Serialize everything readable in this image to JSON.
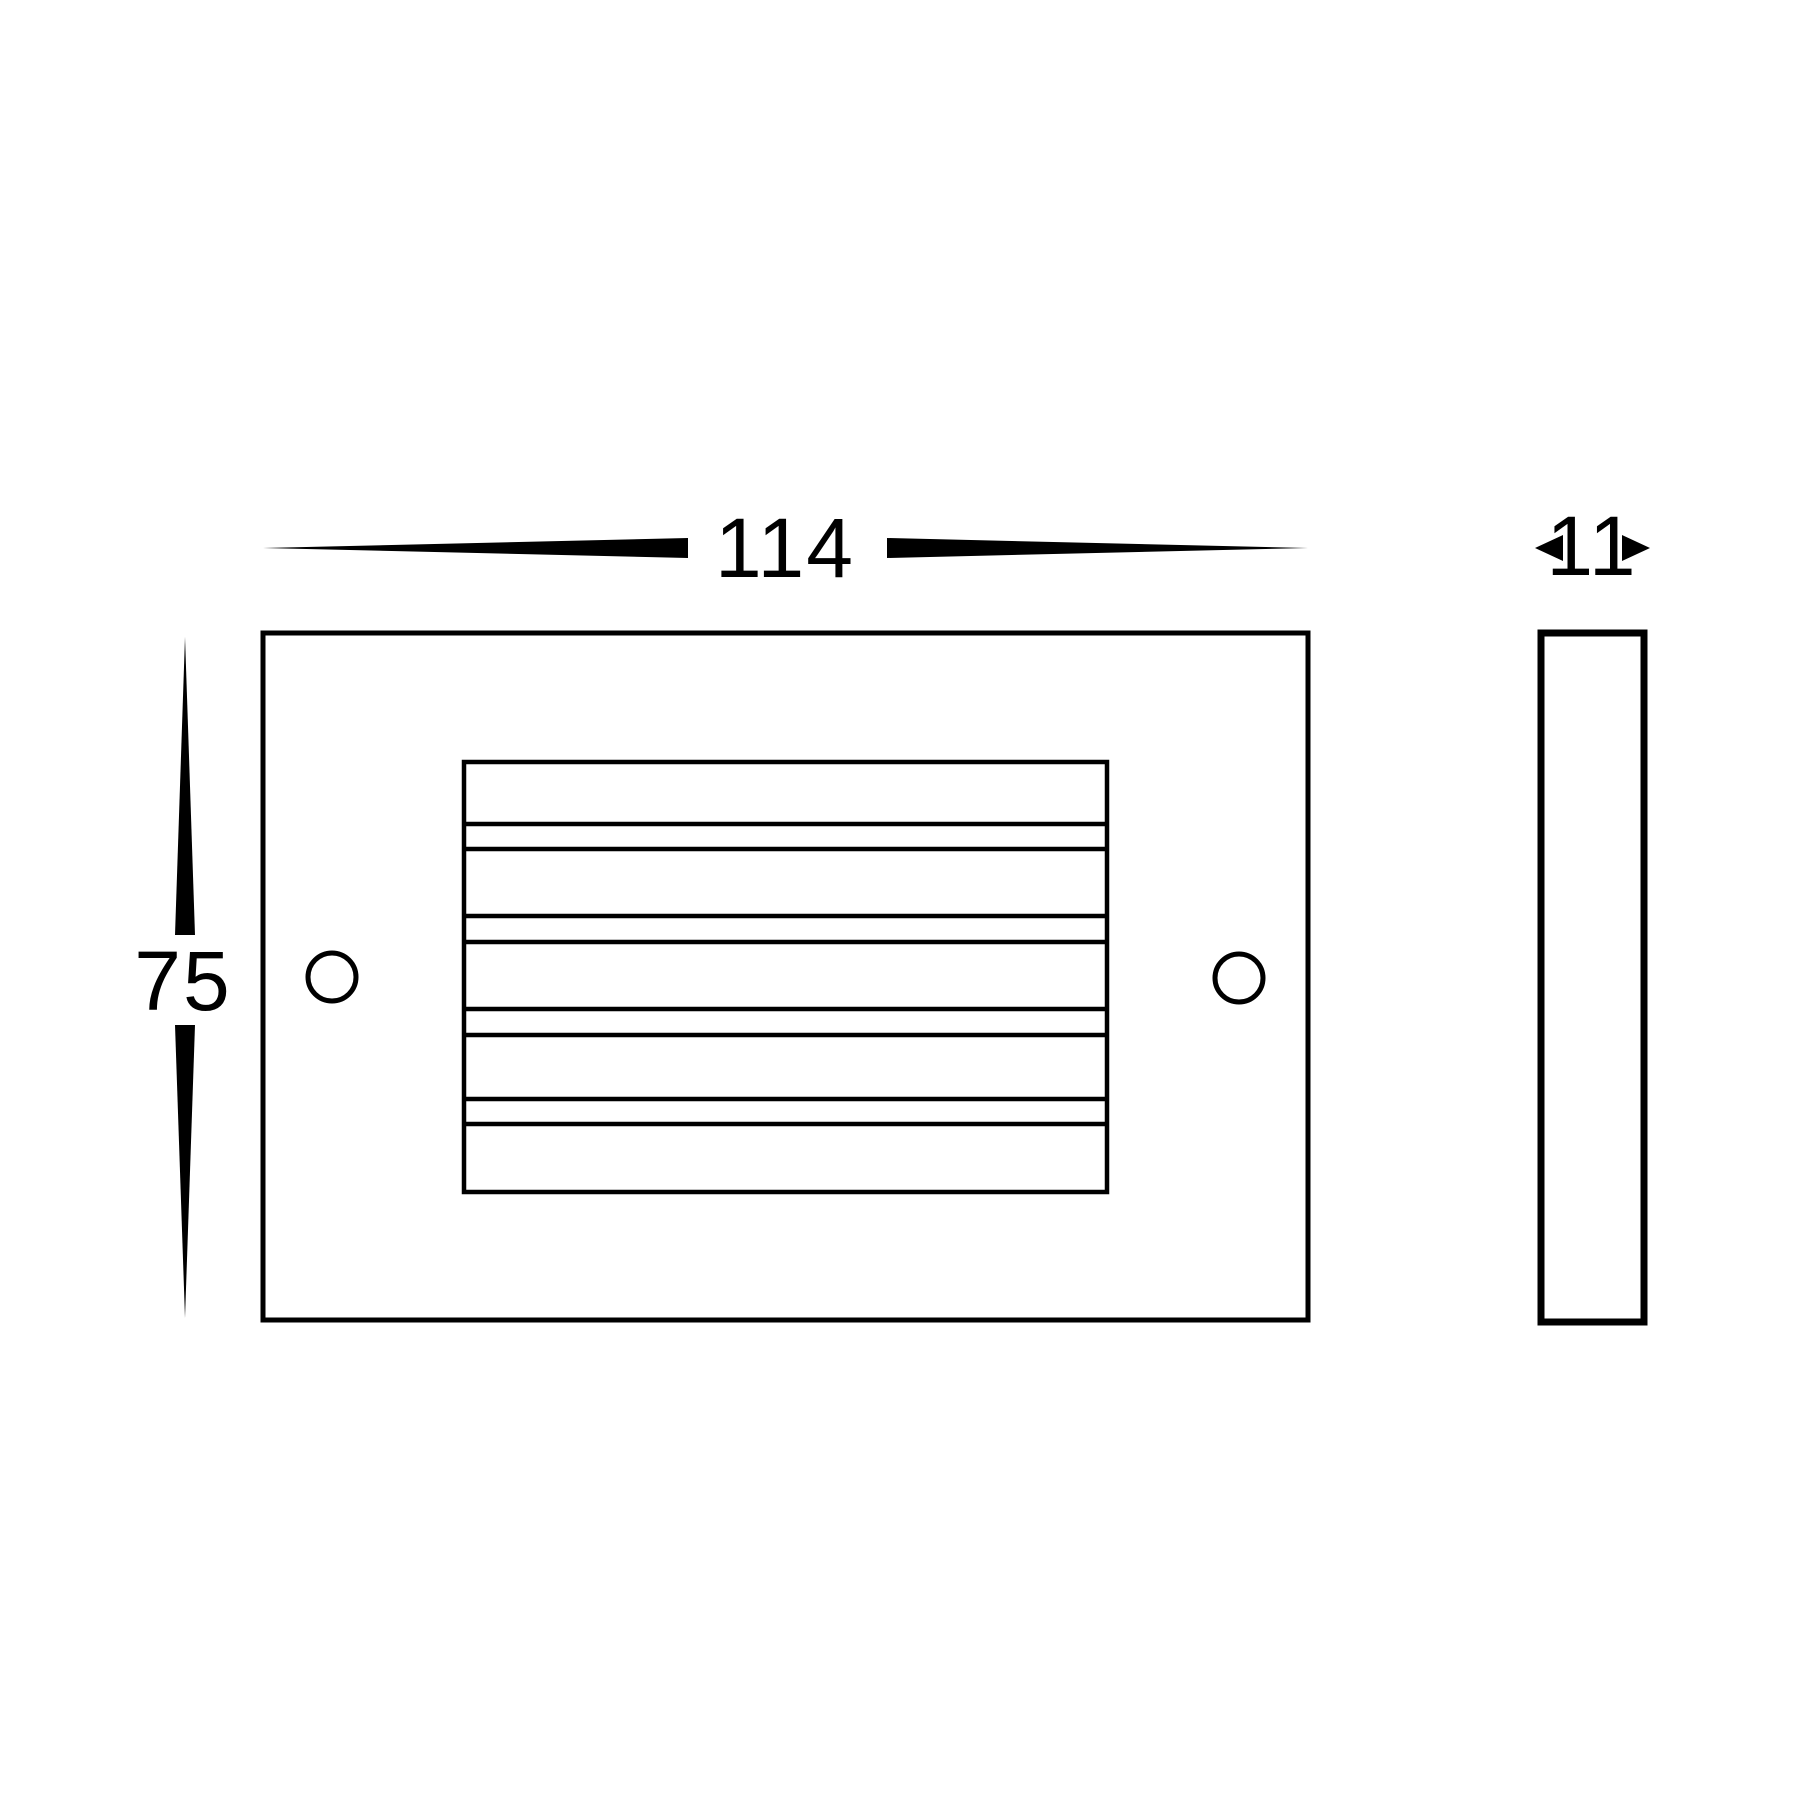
{
  "drawing": {
    "kind": "technical dimension drawing, front and side orthographic views",
    "units_shown": false,
    "background_color": "#ffffff",
    "line_color": "#000000"
  },
  "dimensions": {
    "width_label": "114",
    "height_label": "75",
    "depth_label": "11"
  },
  "front_view": {
    "description": "rectangular face plate with central horizontal louvre grille and two round screw holes",
    "louvre_wide_bands": 5,
    "louvre_narrow_bands": 4,
    "screw_holes": 2
  },
  "side_view": {
    "description": "thin vertical rectangle profile"
  }
}
